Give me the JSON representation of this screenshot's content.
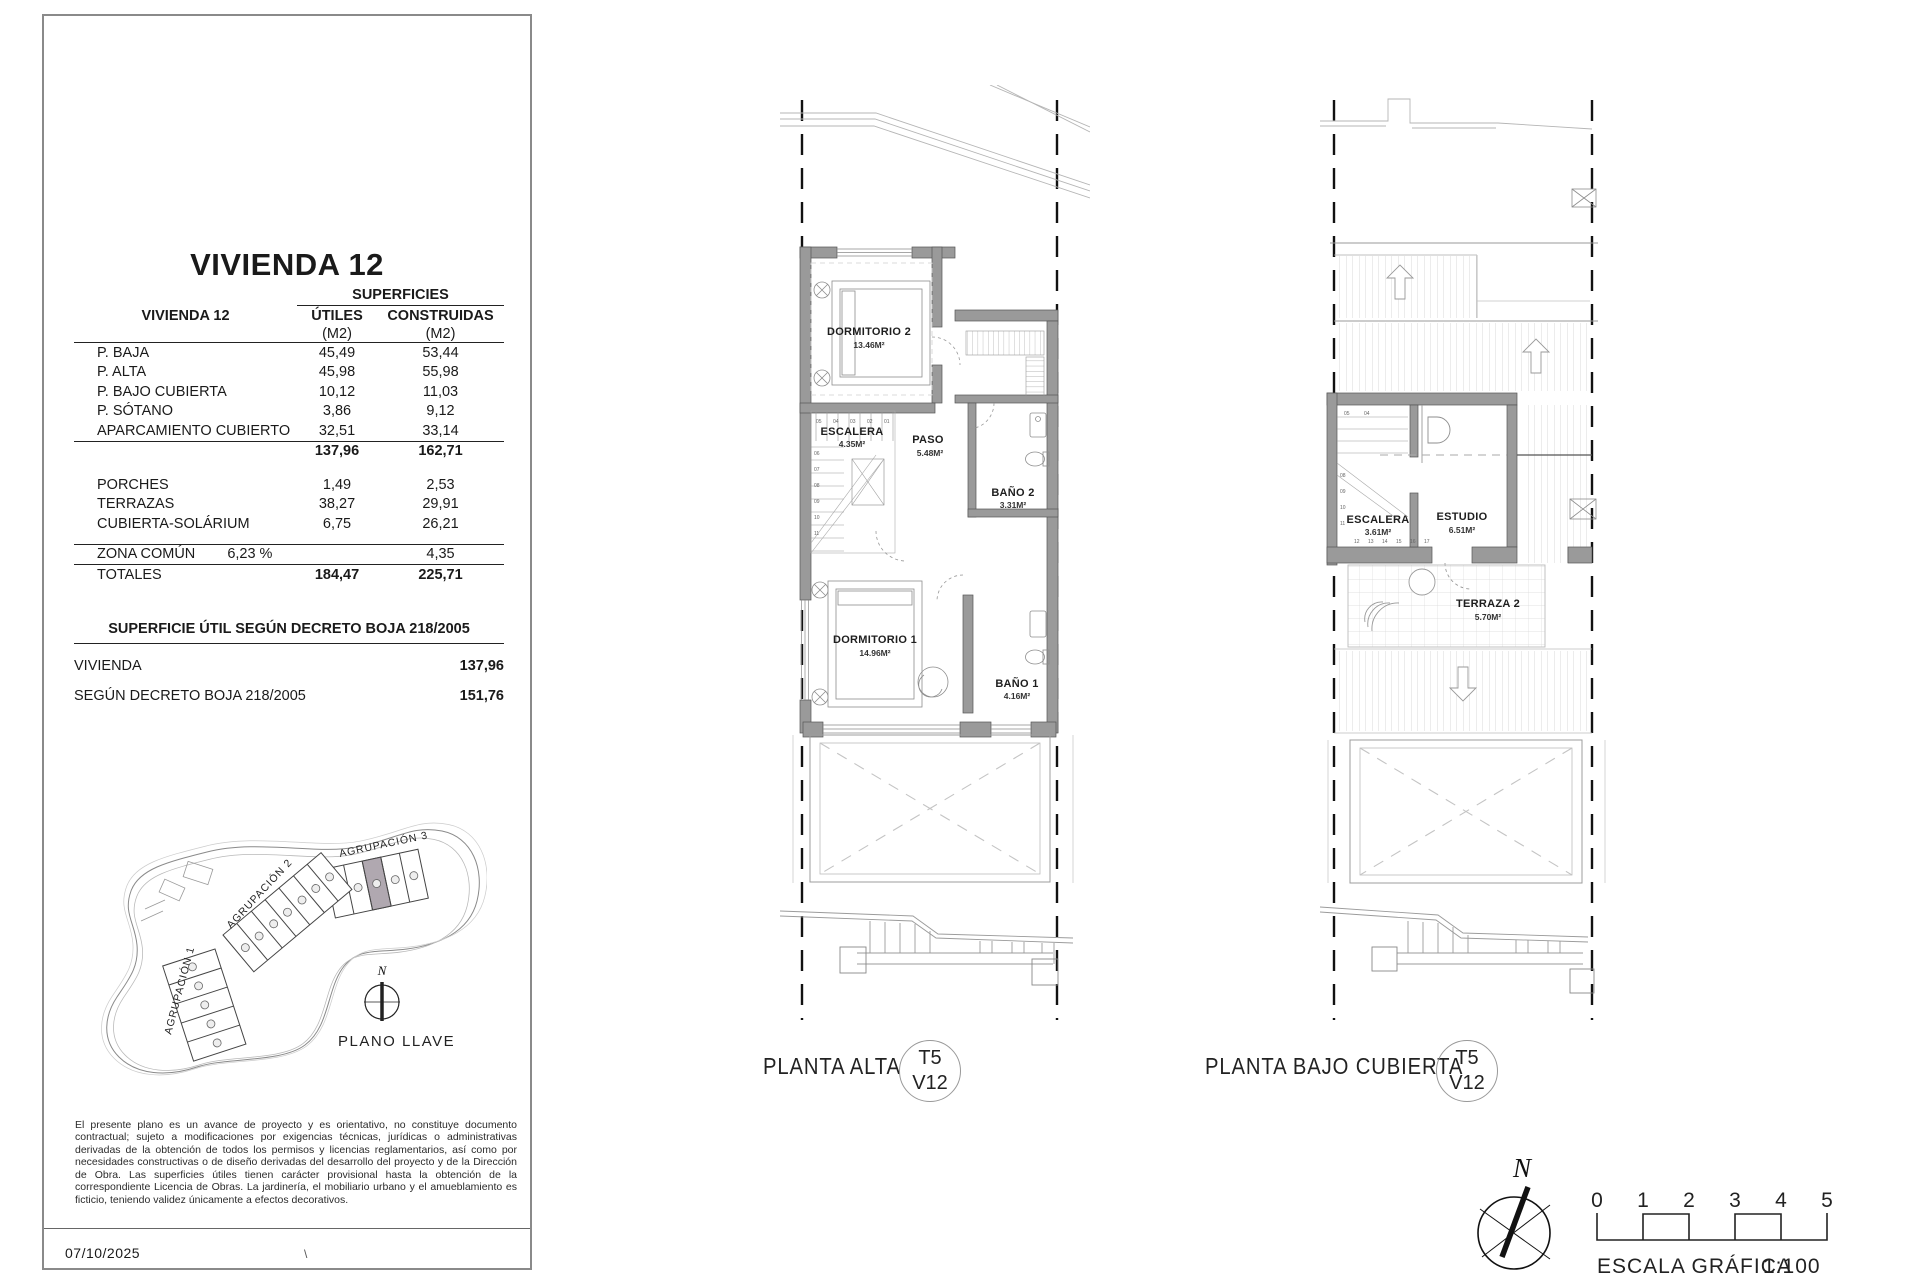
{
  "colors": {
    "wall_gray": "#9a9a9a",
    "highlight_unit": "#b0a8b0",
    "line_dark": "#222222"
  },
  "panel": {
    "title": "VIVIENDA 12",
    "table": {
      "group_header": "SUPERFICIES",
      "row_header": "VIVIENDA 12",
      "col_utiles": "ÚTILES",
      "col_construidas": "CONSTRUIDAS",
      "unit_utiles": "(M2)",
      "unit_construidas": "(M2)",
      "rows": [
        {
          "label": "P. BAJA",
          "utiles": "45,49",
          "construidas": "53,44"
        },
        {
          "label": "P. ALTA",
          "utiles": "45,98",
          "construidas": "55,98"
        },
        {
          "label": "P. BAJO CUBIERTA",
          "utiles": "10,12",
          "construidas": "11,03"
        },
        {
          "label": "P. SÓTANO",
          "utiles": "3,86",
          "construidas": "9,12"
        },
        {
          "label": "APARCAMIENTO CUBIERTO",
          "utiles": "32,51",
          "construidas": "33,14"
        }
      ],
      "subtotal": {
        "utiles": "137,96",
        "construidas": "162,71"
      },
      "rows2": [
        {
          "label": "PORCHES",
          "utiles": "1,49",
          "construidas": "2,53"
        },
        {
          "label": "TERRAZAS",
          "utiles": "38,27",
          "construidas": "29,91"
        },
        {
          "label": "CUBIERTA-SOLÁRIUM",
          "utiles": "6,75",
          "construidas": "26,21"
        }
      ],
      "zona_comun": {
        "label": "ZONA COMÚN",
        "percent": "6,23 %",
        "construidas": "4,35"
      },
      "totals": {
        "label": "TOTALES",
        "utiles": "184,47",
        "construidas": "225,71"
      }
    },
    "decreto": {
      "header": "SUPERFICIE ÚTIL SEGÚN DECRETO BOJA 218/2005",
      "rows": [
        {
          "label": "VIVIENDA",
          "value": "137,96"
        },
        {
          "label": "SEGÚN DECRETO BOJA 218/2005",
          "value": "151,76"
        }
      ]
    },
    "site_plan": {
      "agrupacion1": "AGRUPACIÓN 1",
      "agrupacion2": "AGRUPACIÓN 2",
      "agrupacion3": "AGRUPACIÓN 3",
      "north": "N",
      "caption": "PLANO LLAVE"
    },
    "disclaimer": "El presente plano es un avance de proyecto y es orientativo, no constituye documento contractual; sujeto a modificaciones por exigencias técnicas, jurídicas o administrativas derivadas de la obtención de todos los permisos y licencias reglamentarios, así como por necesidades constructivas o de diseño derivadas del desarrollo del proyecto y de la Dirección de Obra. Las superficies útiles tienen carácter provisional hasta la obtención de la correspondiente Licencia de Obras. La jardinería, el mobiliario urbano y el amueblamiento es ficticio, teniendo validez únicamente a efectos decorativos.",
    "date": "07/10/2025",
    "footer_mark": "\\"
  },
  "plan_alta": {
    "title": "PLANTA ALTA",
    "badge": {
      "line1": "T5",
      "line2": "V12"
    },
    "rooms": {
      "dormitorio2": {
        "name": "DORMITORIO 2",
        "area": "13.46M²"
      },
      "escalera": {
        "name": "ESCALERA",
        "area": "4.35M²"
      },
      "paso": {
        "name": "PASO",
        "area": "5.48M²"
      },
      "bano2": {
        "name": "BAÑO 2",
        "area": "3.31M²"
      },
      "dormitorio1": {
        "name": "DORMITORIO 1",
        "area": "14.96M²"
      },
      "bano1": {
        "name": "BAÑO 1",
        "area": "4.16M²"
      }
    },
    "stair_numbers_top": [
      "05",
      "04",
      "03",
      "02",
      "01"
    ],
    "stair_numbers_side": [
      "06",
      "07",
      "08",
      "09",
      "10",
      "11"
    ]
  },
  "plan_bajo": {
    "title": "PLANTA BAJO CUBIERTA",
    "badge": {
      "line1": "T5",
      "line2": "V12"
    },
    "rooms": {
      "escalera": {
        "name": "ESCALERA",
        "area": "3.61M²"
      },
      "estudio": {
        "name": "ESTUDIO",
        "area": "6.51M²"
      },
      "terraza2": {
        "name": "TERRAZA 2",
        "area": "5.70M²"
      }
    },
    "stair_numbers_top": [
      "05",
      "04"
    ],
    "stair_numbers_side": [
      "08",
      "09",
      "10",
      "11"
    ],
    "stair_numbers_bottom": [
      "12",
      "13",
      "14",
      "15",
      "16",
      "17"
    ]
  },
  "legend": {
    "north": "N",
    "scale_ticks": [
      "0",
      "1",
      "2",
      "3",
      "4",
      "5"
    ],
    "scale_caption": "ESCALA GRÁFICA",
    "scale_ratio": "1:100"
  }
}
